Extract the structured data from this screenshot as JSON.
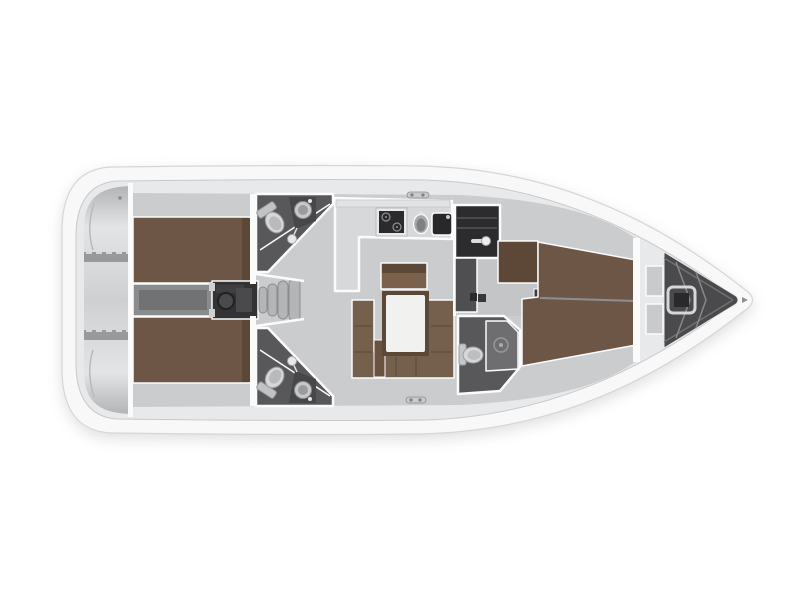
{
  "colors": {
    "hull": "#f8f8f9",
    "hull_line": "#d5d6d7",
    "deck": "#e8e9ea",
    "deck_line": "#c8c9cb",
    "floor": "#cbccce",
    "floor_passage": "#c4c5c7",
    "wall": "#fbfbfc",
    "transom_hi": "#e3e4e6",
    "transom_mid": "#cfd0d2",
    "transom_lo": "#b3b4b6",
    "ledge": "#98999b",
    "berth": "#6e5646",
    "berth_dark": "#5d4837",
    "wood_face": "#7b614c",
    "sofa": "#75604e",
    "sofa_line": "#61503f",
    "table_frame": "#5c4836",
    "table_top": "#f1f1ef",
    "head_floor": "#58585a",
    "shower": "#6e6e70",
    "fixture": "#d6d7d9",
    "fixture_line": "#9b9c9e",
    "counter": "#d7d8da",
    "appliance_dark": "#2b2b2d",
    "basin": "#a9aaac",
    "closet": "#2c2c2e",
    "cabinet": "#4f4f51",
    "engine": "#333335",
    "engine_part": "#4a4a4c",
    "corridor": "#8a8b8d",
    "corridor_inner": "#717274",
    "step": "#b4b5b7",
    "step_line": "#8b8c8e",
    "locker": "#4a4a4c",
    "locker_rib": "#87888a",
    "panel": "#c9cacc",
    "hatch_dark": "#38383a"
  },
  "legend": {
    "boat": "sailing-yacht-floor-plan",
    "hull": "hull",
    "deck": "side-deck",
    "transom": "stern-swim-platform",
    "lazarette": "stern-locker-ledge",
    "aft_cabin_top": "aft-cabin-starboard",
    "aft_cabin_bottom": "aft-cabin-port",
    "berth": "double-berth",
    "engine": "engine-compartment",
    "corridor": "engine-access-corridor",
    "steps": "companionway-steps",
    "head_top": "aft-head-starboard",
    "head_bottom": "aft-head-port",
    "fwd_head": "forward-head",
    "toilet": "toilet",
    "sink": "washbasin",
    "shower": "shower",
    "galley": "galley",
    "stove": "gimbaled-stove",
    "sink_round": "round-galley-sink",
    "sink_square": "square-galley-sink",
    "salon": "salon",
    "table": "salon-table",
    "sofa": "u-shaped-settee",
    "sideboard": "sideboard-bench",
    "stool": "salon-stool",
    "closet": "locker-cabinet",
    "cabinet": "storage-cabinet",
    "wardrobe": "wardrobe",
    "passage": "forward-passageway",
    "fwd_cabin": "forward-cabin",
    "fwd_berth": "forward-double-berth",
    "anchor": "anchor-locker",
    "windlass": "windlass",
    "cleat_top": "mooring-cleat-starboard",
    "cleat_bottom": "mooring-cleat-port"
  }
}
